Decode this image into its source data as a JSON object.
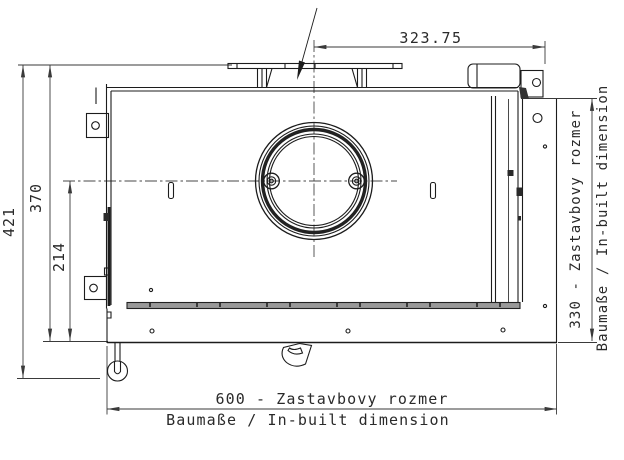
{
  "drawing": {
    "dim_top": {
      "value": "323.75"
    },
    "dim_overall_depth": {
      "value": "421"
    },
    "dim_body_depth": {
      "value": "370"
    },
    "dim_flue_offset": {
      "value": "214"
    },
    "dim_inbuilt_width": {
      "line1": "600 - Zastavbovy rozmer",
      "line2": "Baumaße / In-built dimension"
    },
    "dim_inbuilt_depth": {
      "line1": "330 - Zastavbovy rozmer",
      "line2": "Baumaße / In-built dimension"
    },
    "colors": {
      "line": "#1c1c1c",
      "dim_line": "#3a3a3a",
      "front_bar_fill": "#999999",
      "background": "#ffffff"
    }
  }
}
